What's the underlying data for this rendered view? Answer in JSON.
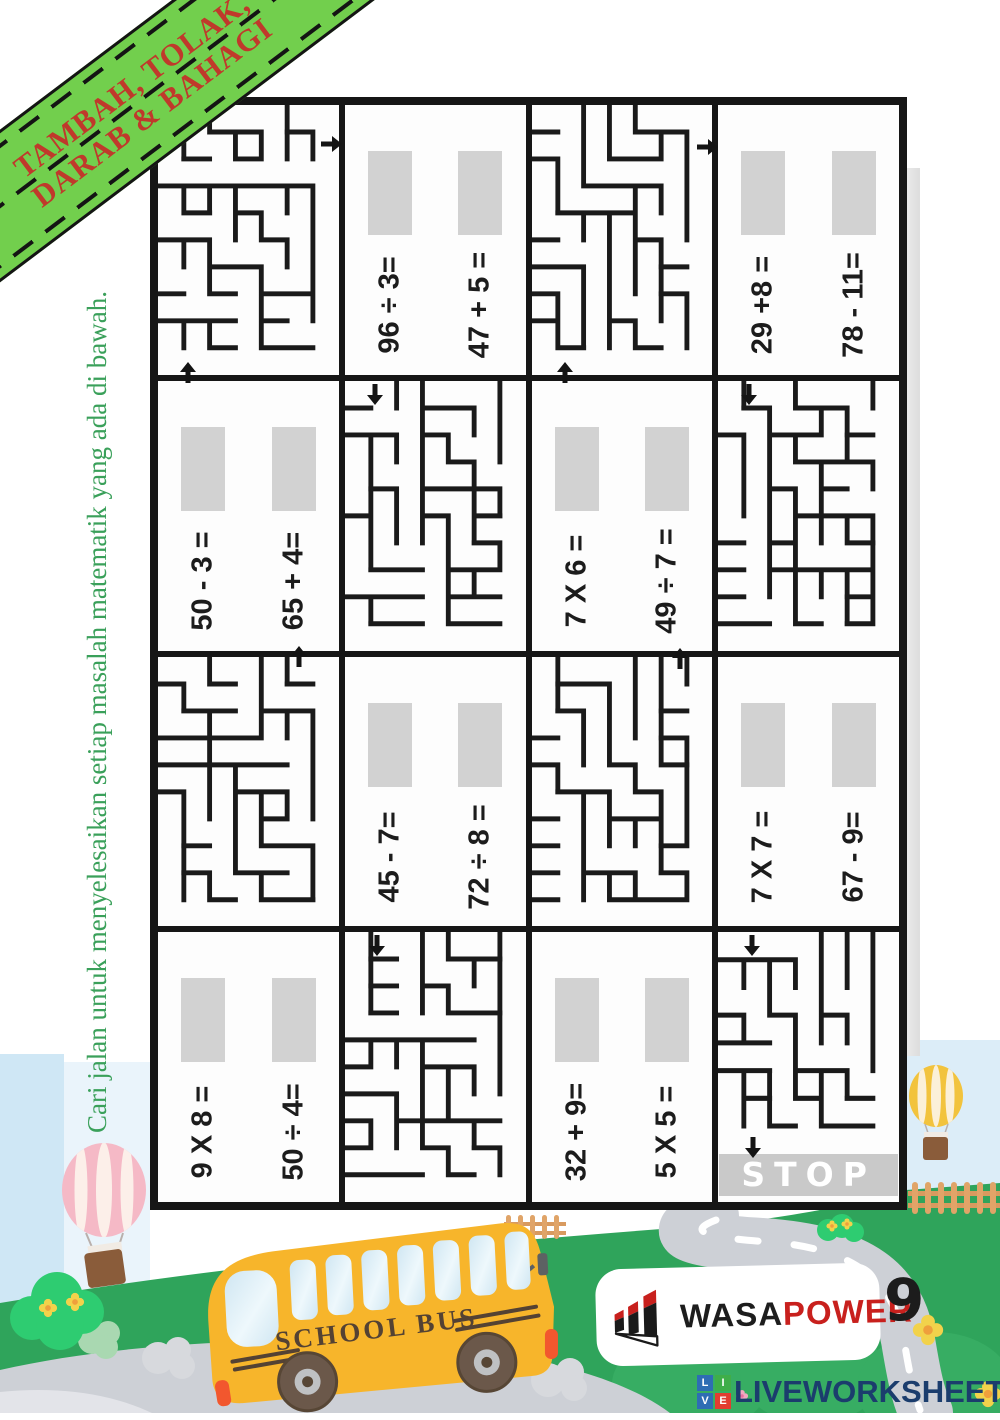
{
  "banner": {
    "line1": "TAMBAH, TOLAK,",
    "line2": "DARAB & BAHAGI"
  },
  "instruction": {
    "text": "Cari jalan untuk menyelesaikan setiap masalah matematik yang ada di bawah."
  },
  "problems": [
    {
      "a": "96 ÷ 3=",
      "b": "47 + 5 ="
    },
    {
      "a": "29 +8 =",
      "b": "78 - 11="
    },
    {
      "a": "50 - 3 =",
      "b": "65 + 4="
    },
    {
      "a": "7 X 6 =",
      "b": "49 ÷ 7 ="
    },
    {
      "a": "45 - 7=",
      "b": "72 ÷ 8 ="
    },
    {
      "a": "7 X 7 =",
      "b": "67 - 9="
    },
    {
      "a": "9 X 8 =",
      "b": "50 ÷ 4="
    },
    {
      "a": "32 + 9=",
      "b": "5 X 5 ="
    }
  ],
  "maze": {
    "stop_label": "STOP"
  },
  "bus": {
    "label": "SCHOOL BUS"
  },
  "brand": {
    "wasa": "WASA",
    "power": "POWER"
  },
  "page_number": "9",
  "footer": {
    "logo_letters": [
      "L",
      "I",
      "V",
      "E"
    ],
    "brand": "LIVEWORKSHEETS"
  },
  "colors": {
    "banner_green": "#72cf4d",
    "banner_text_red": "#c0392b",
    "instruction_green": "#3aa05a",
    "grass_green": "#2fa45b",
    "bus_yellow": "#f7b52b",
    "brand_red": "#c8201d",
    "footer_navy": "#1b3d6d",
    "answer_box_gray": "#d2d2d2",
    "stop_bar_gray": "#c9c9c9"
  }
}
